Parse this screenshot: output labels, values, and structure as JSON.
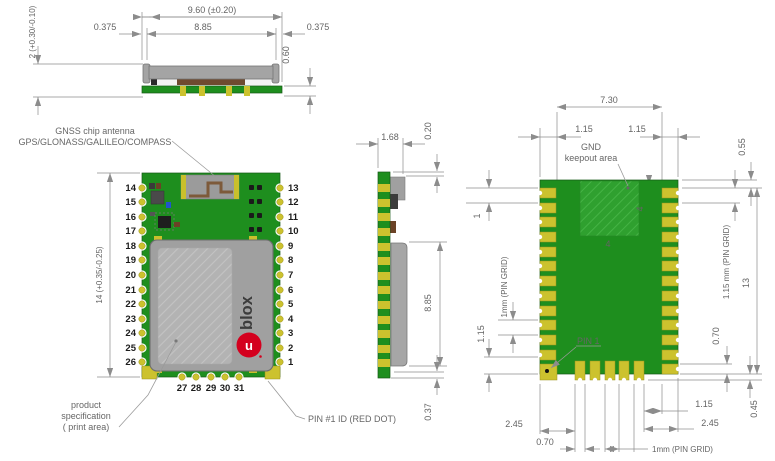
{
  "side": {
    "dim_total": "9.60 (±0.20)",
    "dim_left": "0.375",
    "dim_center": "8.85",
    "dim_right": "0.375",
    "dim_height": "2 (+0.30/-0.10)",
    "dim_stack": "0.60"
  },
  "top": {
    "antenna_label_1": "GNSS chip antenna",
    "antenna_label_2": "GPS/GLONASS/GALILEO/COMPASS",
    "dim_length": "14 (+0.35/-0.25)",
    "left_pins": [
      "14",
      "15",
      "16",
      "17",
      "18",
      "19",
      "20",
      "21",
      "22",
      "23",
      "24",
      "25",
      "26"
    ],
    "right_pins": [
      "13",
      "12",
      "11",
      "10",
      "9",
      "8",
      "7",
      "6",
      "5",
      "4",
      "3",
      "2",
      "1"
    ],
    "bottom_pins": [
      "27",
      "28",
      "29",
      "30",
      "31"
    ],
    "logo_text": "blox",
    "logo_u": "u",
    "print_label_1": "product",
    "print_label_2": "specification",
    "print_label_3": "( print area)",
    "pin1_label": "PIN #1 ID (RED DOT)"
  },
  "profile": {
    "dim_width": "1.68",
    "dim_top": "0.20",
    "dim_height": "8.85",
    "dim_bottom": "0.37"
  },
  "bottom": {
    "dim_span": "7.30",
    "dim_left_115": "1.15",
    "dim_right_115": "1.15",
    "gnd_label_1": "GND",
    "gnd_label_2": "keepout area",
    "dim_055": "0.55",
    "dim_keepout_v": "4",
    "dim_keepout_h": "4",
    "dim_first_pitch": "1",
    "pin_grid_left": "1mm (PIN GRID)",
    "dim_left_bottom_115": "1.15",
    "pin_grid_right": "1.15 mm (PIN GRID)",
    "dim_pin_span": "13",
    "dim_pad_h": "0.70",
    "pin1_label": "PIN 1",
    "dim_bl_245": "2.45",
    "dim_bl_070": "0.70",
    "dim_br_115": "1.15",
    "dim_br_245": "2.45",
    "dim_045": "0.45",
    "pin_grid_bottom": "1mm (PIN GRID)"
  },
  "colors": {
    "pcb_green": "#1e8e1e",
    "keepout_green": "#2fa02f",
    "pad_yellow": "#ccc22e",
    "shield_gray": "#a4a4a4",
    "brand_red": "#d4001e",
    "dim_gray": "#8c8c8c"
  }
}
